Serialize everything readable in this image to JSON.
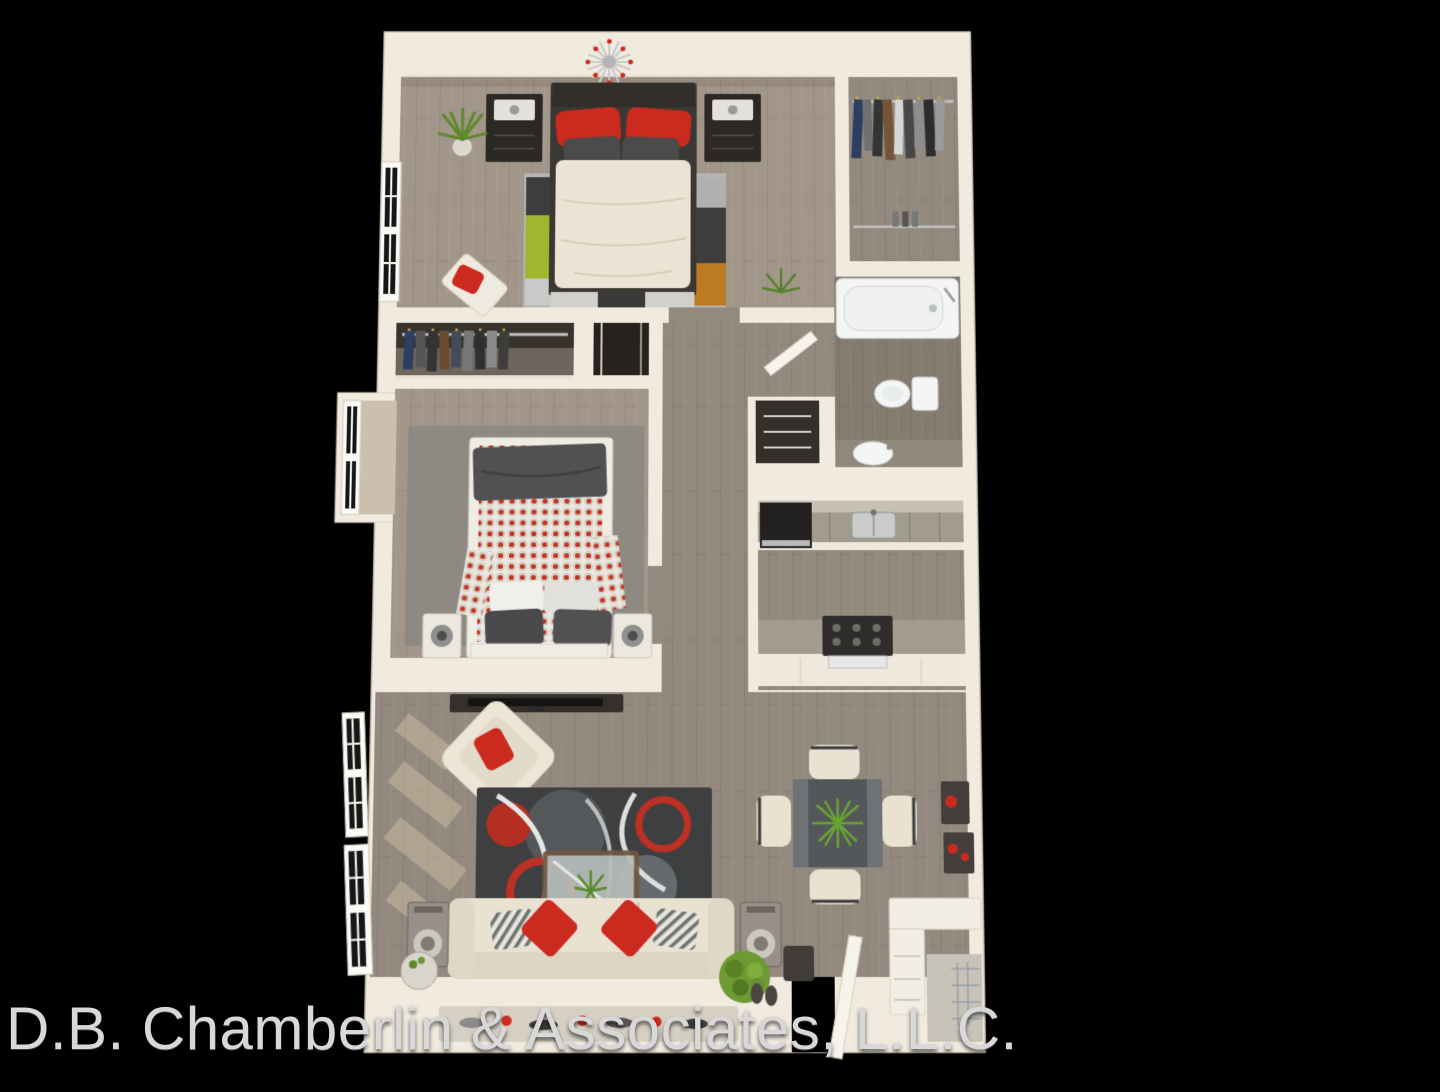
{
  "watermark": {
    "text": "D.B. Chamberlin & Associates, L.L.C."
  },
  "palette": {
    "background": "#000000",
    "wall": "#f1ebdf",
    "wall_shade": "#ddd4c3",
    "wood_master": "#a2968a",
    "wood_common": "#93897e",
    "wood_dark": "#857b71",
    "accent_red": "#cd2a1f",
    "rug_lime": "#9fb62f",
    "rug_orange": "#bc7a21",
    "rug_charcoal": "#3d3d3d",
    "rug_silver": "#b5b5b5",
    "living_rug": "#3d3f41",
    "sofa_cream": "#e9e2d1",
    "plant_green": "#5d8a2b",
    "fixture_white": "#f4f6f5",
    "counter_gray": "#a29c8e",
    "furniture_dark": "#2b2826",
    "dining_table_gray": "#53575a",
    "bed2_blanket": "#515153",
    "watermark_color": "#d8d8d8"
  },
  "scene": {
    "type": "3d-floor-plan-render",
    "rooms": [
      {
        "name": "master-bedroom",
        "furniture": [
          "sputnik-chandelier",
          "double-bed-red-pillows",
          "nightstand-left",
          "nightstand-right",
          "colorblock-rug",
          "potted-plant",
          "tufted-bench",
          "window"
        ]
      },
      {
        "name": "walk-in-closet",
        "furniture": [
          "clothes-rod-upper",
          "clothes-rod-lower",
          "hanging-clothes"
        ]
      },
      {
        "name": "bathroom",
        "furniture": [
          "bathtub",
          "toilet",
          "vanity-sink",
          "door"
        ]
      },
      {
        "name": "second-bedroom",
        "furniture": [
          "bed-red-dot-duvet",
          "gray-rug",
          "speaker-left",
          "speaker-right",
          "bay-window",
          "reach-in-closet",
          "mirror-closet"
        ]
      },
      {
        "name": "hallway",
        "furniture": [
          "linen-closet"
        ]
      },
      {
        "name": "kitchen",
        "furniture": [
          "sink-counter",
          "black-appliance",
          "range-peninsula"
        ]
      },
      {
        "name": "living-room",
        "furniture": [
          "tv-console",
          "flat-tv",
          "armchair-red-pillow",
          "circle-pattern-rug",
          "glass-coffee-table",
          "cream-sofa",
          "speaker-left",
          "speaker-right",
          "side-table",
          "shrub-plant",
          "tall-windows"
        ]
      },
      {
        "name": "dining-area",
        "furniture": [
          "square-table",
          "four-chairs",
          "centerpiece-plant",
          "wall-shelves-red-decor"
        ]
      },
      {
        "name": "entry",
        "furniture": [
          "open-door",
          "console-cabinet",
          "corner-closet",
          "runner-rug"
        ]
      }
    ]
  }
}
